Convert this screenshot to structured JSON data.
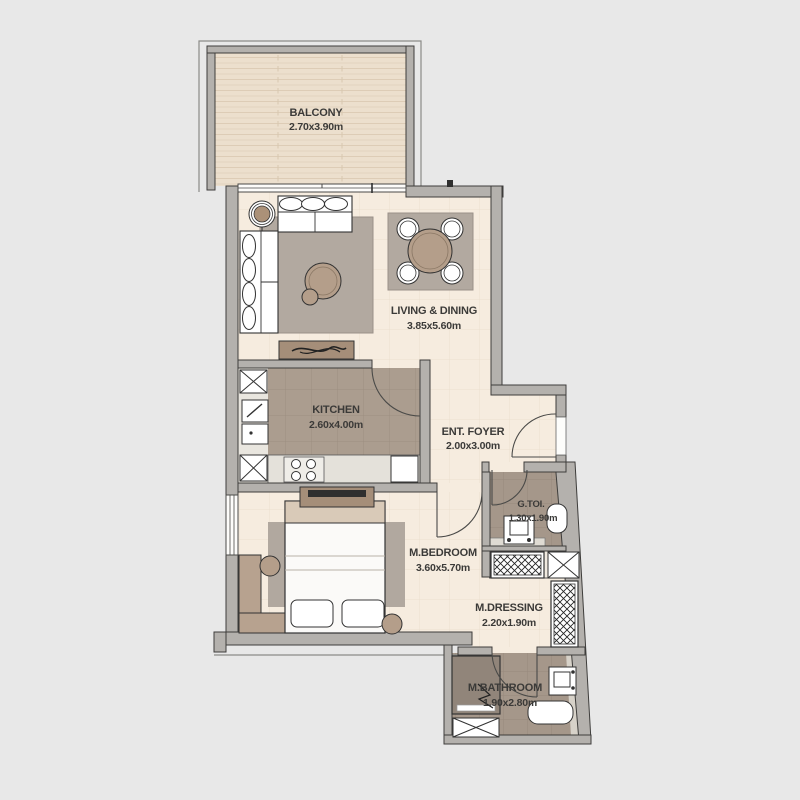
{
  "plan": {
    "rooms": [
      {
        "id": "balcony",
        "name": "BALCONY",
        "dims": "2.70x3.90m"
      },
      {
        "id": "living",
        "name": "LIVING & DINING",
        "dims": "3.85x5.60m"
      },
      {
        "id": "kitchen",
        "name": "KITCHEN",
        "dims": "2.60x4.00m"
      },
      {
        "id": "foyer",
        "name": "ENT. FOYER",
        "dims": "2.00x3.00m"
      },
      {
        "id": "gtoi",
        "name": "G.TOI.",
        "dims": "1.30x1.90m"
      },
      {
        "id": "mbedroom",
        "name": "M.BEDROOM",
        "dims": "3.60x5.70m"
      },
      {
        "id": "mdressing",
        "name": "M.DRESSING",
        "dims": "2.20x1.90m"
      },
      {
        "id": "mbathroom",
        "name": "M.BATHROOM",
        "dims": "1.90x2.80m"
      }
    ],
    "furniture_icons": [
      "sofa-icon",
      "coffee-table-icon",
      "plant-icon",
      "tv-console-icon",
      "dining-table-icon",
      "dining-chair-icon",
      "stove-icon",
      "kitchen-sink-icon",
      "fridge-icon",
      "duct-icon",
      "bed-icon",
      "nightstand-icon",
      "bench-icon",
      "rug",
      "wardrobe-icon",
      "toilet-icon",
      "washbasin-icon",
      "shower-icon",
      "bathtub-icon",
      "door-swing-icon",
      "window-icon",
      "sliding-door-icon"
    ],
    "colors": {
      "background": "#e8e8e8",
      "wall": "#b4b1ad",
      "outline": "#3e3d3b",
      "floor_cream": "#f6ecdf",
      "floor_kitchen": "#ab9d8f",
      "floor_bath": "#a5978a",
      "balcony_deck": "#ecdfcd",
      "rug": "#b2a9a0",
      "wood": "#b49e8a",
      "label_text": "#3b3a38"
    }
  }
}
